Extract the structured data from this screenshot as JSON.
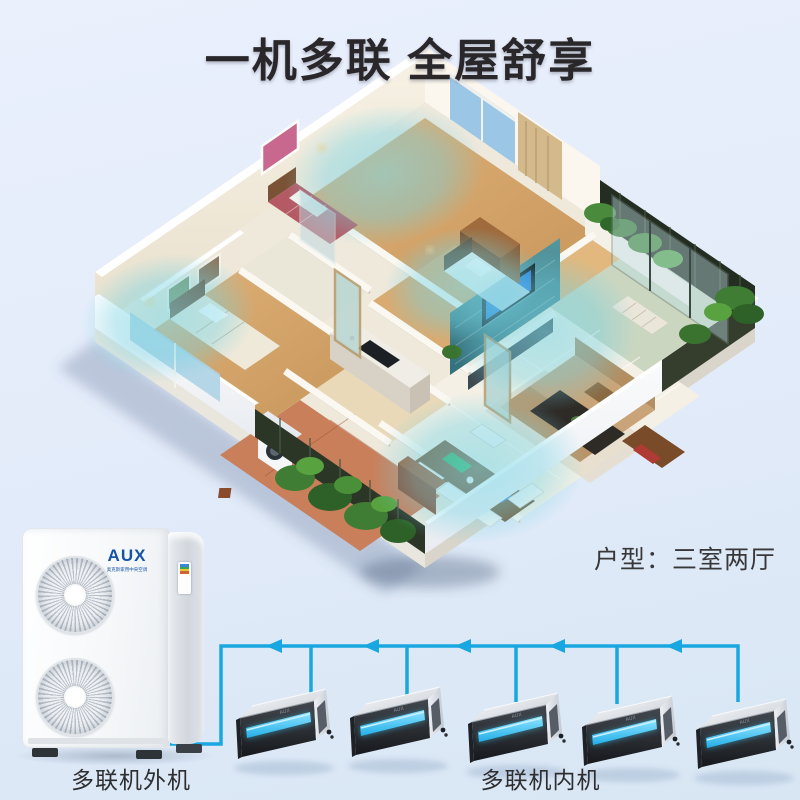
{
  "title": "一机多联 全屋舒享",
  "floorplan": {
    "caption": "户型：三室两厅"
  },
  "outdoor_unit": {
    "label": "多联机外机",
    "brand": "AUX",
    "brand_subtitle": "奥克斯家用中央空调"
  },
  "indoor_units": {
    "label": "多联机内机",
    "count": 5,
    "brand": "AUX"
  },
  "colors": {
    "background_top": "#eaf0fc",
    "background_bottom": "#d8e6f4",
    "pipe_cyan": "#18a7e0",
    "airflow_cyan": "#7dd8e6",
    "brand_blue": "#1454a4",
    "title_text": "#29272a",
    "label_text": "#2e2e30"
  }
}
